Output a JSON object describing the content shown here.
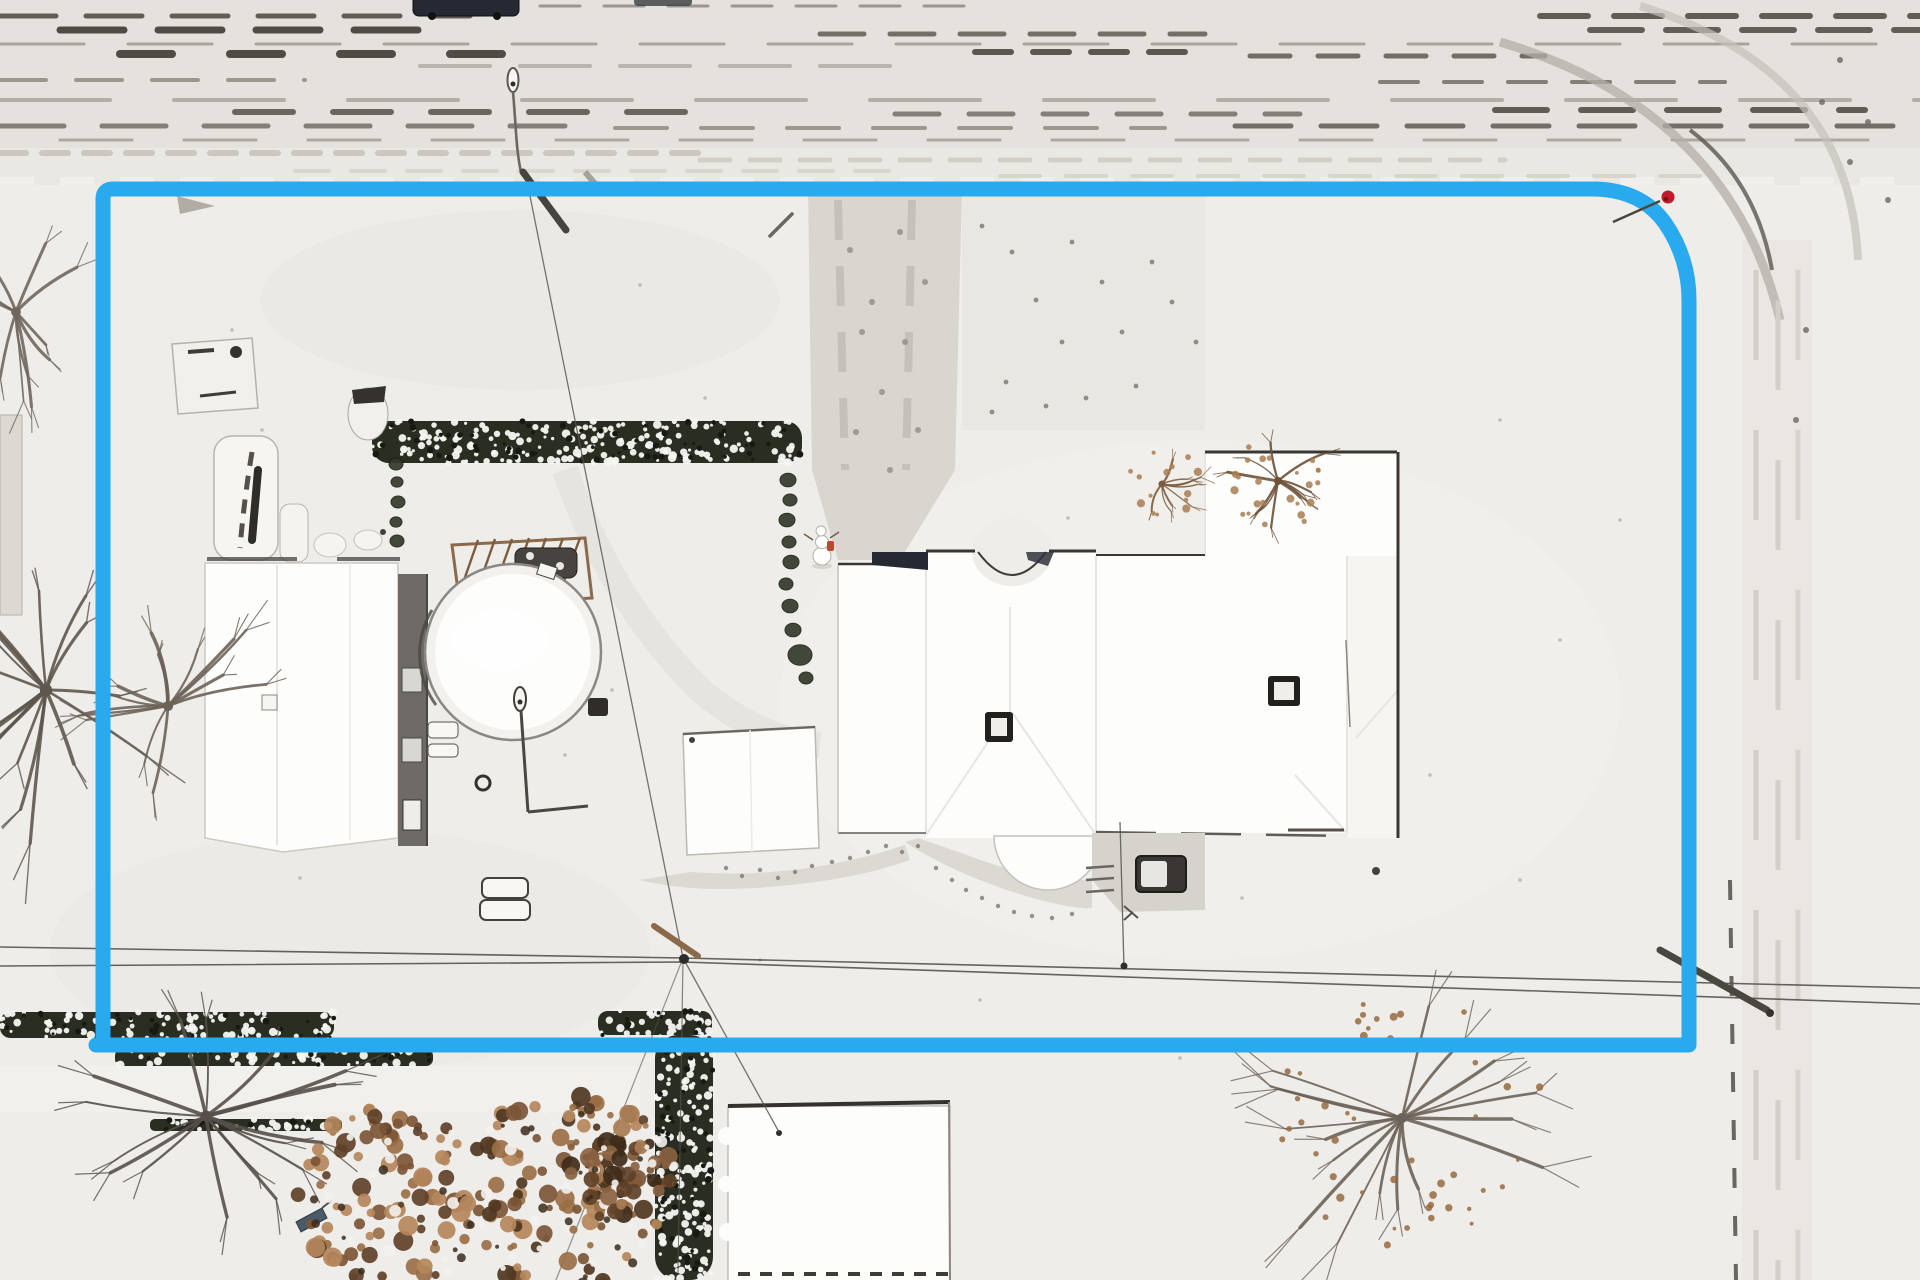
{
  "scene": {
    "description": "Winter aerial drone photograph of a snow-covered rural property outlined with a bright blue property-boundary overlay; barn, round pool, shed, large house, hedges, bare trees, roads and power lines visible",
    "colors": {
      "snow": "#efede9",
      "snow_bright": "#fdfdfc",
      "road": "#e5e2dd",
      "road_light": "#eae8e3",
      "driveway": "#d9d6d0",
      "trampled": "#d8d5cf",
      "patio": "#d6d3cd",
      "boundary": "#29a9ee",
      "marker": "#c11a28",
      "hedge": "#2a2e22",
      "hedge_snow": "#f6f5f2",
      "wood": "#8a6a4a",
      "wall": "#6e6b66",
      "dark": "#3a3733",
      "navy": "#262833",
      "wire": "#55524d"
    },
    "boundary": {
      "color": "#29a9ee",
      "stroke_width": 15,
      "path": "M 96 1045 H 1689 V 300 Q 1689 258 1665 223 Q 1641 189 1592 189 H 113 Q 103 189 103 199 V 1045 Z",
      "marker_color": "#c11a28"
    },
    "texture": {
      "streaks": [
        [
          6,
          540,
          980,
          3,
          "#8b867e",
          "40 24",
          0.8
        ],
        [
          16,
          0,
          470,
          5,
          "#4a463f",
          "56 30",
          0.85
        ],
        [
          16,
          1540,
          1920,
          6,
          "#4a463f",
          "48 26",
          0.85
        ],
        [
          30,
          60,
          430,
          7,
          "#3f3b35",
          "64 34",
          0.9
        ],
        [
          34,
          820,
          1205,
          5,
          "#5f5b53",
          "44 26",
          0.85
        ],
        [
          30,
          1590,
          1920,
          6,
          "#55514a",
          "52 24",
          0.9
        ],
        [
          44,
          0,
          1920,
          3,
          "#9a958d",
          "84 44",
          0.8
        ],
        [
          54,
          120,
          510,
          8,
          "#3f3b35",
          "52 58",
          0.9
        ],
        [
          52,
          975,
          1185,
          6,
          "#44403a",
          "36 22",
          0.85
        ],
        [
          56,
          1250,
          1545,
          5,
          "#55514a",
          "40 28",
          0.8
        ],
        [
          66,
          420,
          905,
          4,
          "#b5b0a8",
          "70 30",
          0.9
        ],
        [
          80,
          0,
          305,
          4,
          "#8b867e",
          "46 30",
          0.8
        ],
        [
          82,
          1380,
          1725,
          4,
          "#6a675f",
          "38 26",
          0.8
        ],
        [
          100,
          0,
          1920,
          4,
          "#aba69e",
          "110 64",
          0.85
        ],
        [
          112,
          235,
          725,
          6,
          "#55514a",
          "58 40",
          0.85
        ],
        [
          114,
          895,
          1300,
          5,
          "#6a675f",
          "44 30",
          0.8
        ],
        [
          110,
          1495,
          1865,
          6,
          "#4a463f",
          "52 34",
          0.85
        ],
        [
          126,
          0,
          565,
          5,
          "#6a675f",
          "64 38",
          0.8
        ],
        [
          128,
          615,
          1165,
          4,
          "#8b867e",
          "52 34",
          0.8
        ],
        [
          126,
          1235,
          1920,
          5,
          "#55514a",
          "56 30",
          0.8
        ],
        [
          140,
          60,
          1920,
          3,
          "#9a958d",
          "72 52",
          0.75
        ],
        [
          153,
          0,
          705,
          6,
          "#c9c5be",
          "26 16",
          0.9
        ],
        [
          160,
          700,
          1505,
          5,
          "#cfcbc4",
          "30 20",
          0.85
        ],
        [
          171,
          295,
          905,
          4,
          "#d8d4cd",
          "34 22",
          0.9
        ],
        [
          176,
          1000,
          1700,
          4,
          "#d4d0c9",
          "40 26",
          0.8
        ]
      ]
    },
    "hedges": [
      {
        "id": "hedge-upper",
        "x": 372,
        "y": 421,
        "w": 430,
        "h": 42,
        "seed": 5
      },
      {
        "id": "hedge-road-left",
        "x": 0,
        "y": 1012,
        "w": 334,
        "h": 26,
        "seed": 9
      },
      {
        "id": "hedge-below-line",
        "x": 115,
        "y": 1049,
        "w": 318,
        "h": 17,
        "seed": 13
      },
      {
        "id": "hedge-mid-bottom",
        "x": 598,
        "y": 1011,
        "w": 114,
        "h": 24,
        "seed": 17
      },
      {
        "id": "hedge-vertical",
        "x": 655,
        "y": 1035,
        "w": 58,
        "h": 245,
        "seed": 19
      },
      {
        "id": "hedge-thin-row",
        "x": 150,
        "y": 1119,
        "w": 192,
        "h": 12,
        "seed": 21
      }
    ],
    "bushes": [
      [
        396,
        464,
        7
      ],
      [
        397,
        482,
        6
      ],
      [
        398,
        502,
        7
      ],
      [
        396,
        522,
        6
      ],
      [
        397,
        541,
        7
      ],
      [
        788,
        480,
        8
      ],
      [
        790,
        500,
        7
      ],
      [
        787,
        520,
        8
      ],
      [
        789,
        542,
        7
      ],
      [
        791,
        562,
        8
      ],
      [
        786,
        584,
        7
      ],
      [
        790,
        606,
        8
      ],
      [
        793,
        630,
        8
      ],
      [
        800,
        655,
        12
      ],
      [
        806,
        678,
        7
      ]
    ],
    "trees": [
      {
        "id": "tree-left-outer",
        "cx": 46,
        "cy": 690,
        "r": 155,
        "limbs": 17,
        "w": 2.8,
        "color": "#5d564e",
        "seed": 7
      },
      {
        "id": "tree-left-inner",
        "cx": 168,
        "cy": 706,
        "r": 115,
        "limbs": 14,
        "w": 2.3,
        "color": "#6b6258",
        "seed": 11
      },
      {
        "id": "tree-top-left",
        "cx": 16,
        "cy": 312,
        "r": 98,
        "limbs": 11,
        "w": 2.2,
        "color": "#6f675e",
        "seed": 23
      },
      {
        "id": "tree-bottom-left",
        "cx": 206,
        "cy": 1116,
        "r": 150,
        "limbs": 16,
        "w": 2.5,
        "color": "#57504a",
        "seed": 31
      },
      {
        "id": "tree-bottom-right",
        "cx": 1402,
        "cy": 1118,
        "r": 150,
        "limbs": 18,
        "w": 2.3,
        "color": "#6b6258",
        "seed": 43,
        "leaf_color": "#96693f",
        "leaf_n": 46
      },
      {
        "id": "shrub-house-left",
        "cx": 1162,
        "cy": 484,
        "r": 42,
        "limbs": 9,
        "w": 1.6,
        "color": "#7c5c40",
        "seed": 53,
        "leaf_color": "#a87c52",
        "leaf_n": 14
      },
      {
        "id": "shrub-house-right",
        "cx": 1278,
        "cy": 481,
        "r": 55,
        "limbs": 11,
        "w": 1.8,
        "color": "#6f5138",
        "seed": 59,
        "leaf_color": "#a87c52",
        "leaf_n": 24
      }
    ],
    "leafy": [
      {
        "id": "oak-bottom-left",
        "cx": 392,
        "cy": 1198,
        "r": 95,
        "n": 95,
        "seed": 67,
        "palette": [
          "#9a6f47",
          "#b5875c",
          "#7c5636",
          "#5f4128"
        ]
      },
      {
        "id": "oak-bottom-mid",
        "cx": 565,
        "cy": 1192,
        "r": 102,
        "n": 115,
        "seed": 71,
        "palette": [
          "#9a6f47",
          "#b5875c",
          "#7c5636",
          "#4f3722"
        ]
      },
      {
        "id": "oak-hedge-small",
        "cx": 622,
        "cy": 1168,
        "r": 55,
        "n": 48,
        "seed": 83,
        "palette": [
          "#8a6240",
          "#a87c52",
          "#5f4128",
          "#3f2c1a"
        ]
      }
    ],
    "speckles": [
      {
        "id": "footpath-dots",
        "color": "#7d7871",
        "r": 2.2,
        "opacity": 0.8,
        "points": [
          [
            812,
            866
          ],
          [
            795,
            872
          ],
          [
            778,
            878
          ],
          [
            760,
            870
          ],
          [
            742,
            876
          ],
          [
            726,
            868
          ],
          [
            850,
            858
          ],
          [
            868,
            852
          ],
          [
            886,
            846
          ],
          [
            832,
            862
          ],
          [
            902,
            852
          ],
          [
            918,
            846
          ],
          [
            936,
            868
          ],
          [
            952,
            880
          ],
          [
            966,
            890
          ],
          [
            982,
            898
          ],
          [
            998,
            906
          ],
          [
            1014,
            912
          ],
          [
            1032,
            916
          ],
          [
            1052,
            918
          ],
          [
            1072,
            914
          ]
        ]
      },
      {
        "id": "driveway-marks",
        "color": "#8b867e",
        "r": 3,
        "opacity": 0.75,
        "points": [
          [
            850,
            250
          ],
          [
            872,
            302
          ],
          [
            905,
            342
          ],
          [
            882,
            392
          ],
          [
            856,
            432
          ],
          [
            900,
            232
          ],
          [
            925,
            282
          ],
          [
            862,
            332
          ],
          [
            890,
            470
          ],
          [
            918,
            430
          ]
        ]
      },
      {
        "id": "gravel-marks",
        "color": "#6a675f",
        "r": 2.4,
        "opacity": 0.7,
        "points": [
          [
            982,
            226
          ],
          [
            1012,
            252
          ],
          [
            1036,
            300
          ],
          [
            1062,
            342
          ],
          [
            1006,
            382
          ],
          [
            1046,
            406
          ],
          [
            992,
            412
          ],
          [
            1072,
            242
          ],
          [
            1102,
            282
          ],
          [
            1122,
            332
          ],
          [
            1152,
            262
          ],
          [
            1172,
            302
          ],
          [
            1196,
            342
          ],
          [
            1086,
            398
          ],
          [
            1136,
            386
          ]
        ]
      },
      {
        "id": "yard-specks",
        "color": "#9a958d",
        "r": 1.8,
        "opacity": 0.55,
        "points": [
          [
            640,
            285
          ],
          [
            705,
            398
          ],
          [
            612,
            690
          ],
          [
            565,
            755
          ],
          [
            905,
            630
          ],
          [
            1068,
            518
          ],
          [
            388,
            695
          ],
          [
            344,
            768
          ],
          [
            300,
            878
          ],
          [
            1242,
            898
          ],
          [
            1430,
            775
          ],
          [
            1500,
            420
          ],
          [
            1560,
            640
          ],
          [
            760,
            960
          ],
          [
            980,
            1000
          ],
          [
            1180,
            1058
          ],
          [
            262,
            430
          ],
          [
            232,
            330
          ],
          [
            1620,
            520
          ],
          [
            1520,
            880
          ]
        ]
      },
      {
        "id": "corner-specks",
        "color": "#6a675f",
        "r": 3,
        "opacity": 0.8,
        "points": [
          [
            1840,
            60
          ],
          [
            1868,
            122
          ],
          [
            1888,
            200
          ],
          [
            1850,
            162
          ],
          [
            1822,
            102
          ],
          [
            1806,
            330
          ],
          [
            1796,
            420
          ]
        ]
      }
    ]
  }
}
